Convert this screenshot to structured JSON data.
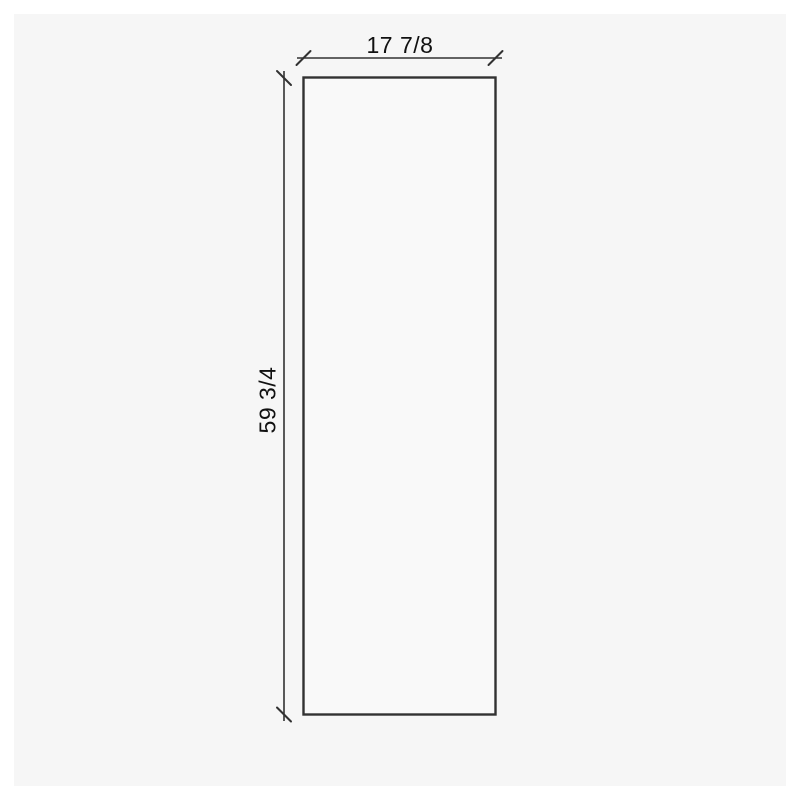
{
  "drawing": {
    "type": "dimensioned-panel-drawing",
    "shape": "rectangle",
    "width_dimension": "17 7/8",
    "height_dimension": "59 3/4"
  },
  "colors": {
    "page": "#ffffff",
    "canvas_background": "#f6f6f6",
    "panel_fill": "#f9f9f9",
    "line": "#323232",
    "text": "#111111"
  }
}
